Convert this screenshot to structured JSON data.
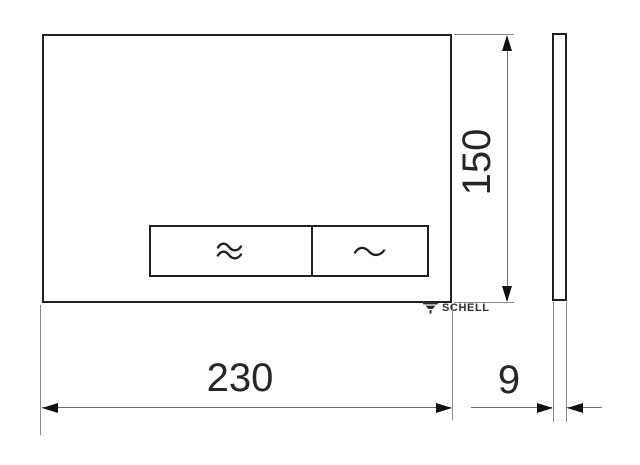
{
  "drawing": {
    "title": "SCHELL flush plate dimensional drawing",
    "brand": "SCHELL",
    "dimensions": {
      "width_label": "230",
      "height_label": "150",
      "depth_label": "9"
    },
    "front_view": {
      "logo_text": "SCHELL",
      "buttons": [
        {
          "name": "full-flush-button",
          "symbol": "≈",
          "symbol_name": "double-wave-icon"
        },
        {
          "name": "eco-flush-button",
          "symbol": "~",
          "symbol_name": "single-wave-icon"
        }
      ]
    },
    "colors": {
      "outline": "#1f1f1f",
      "dimension_line": "#6f6f6f",
      "extension_line": "#8a8a8a",
      "arrow": "#111111",
      "background": "#ffffff"
    }
  }
}
